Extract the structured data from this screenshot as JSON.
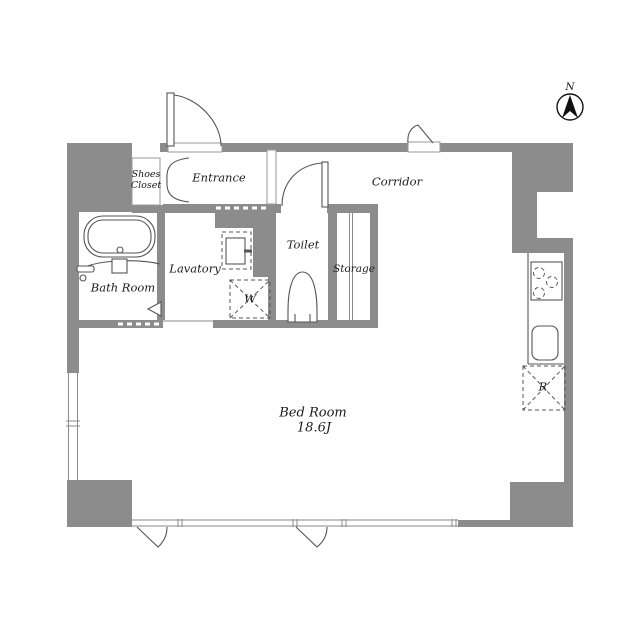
{
  "title": "Floor plan",
  "compass": {
    "north": "N"
  },
  "rooms": {
    "shoes_closet": {
      "line1": "Shoes",
      "line2": "Closet"
    },
    "entrance": {
      "label": "Entrance"
    },
    "corridor": {
      "label": "Corridor"
    },
    "toilet": {
      "label": "Toilet"
    },
    "storage": {
      "label": "Storage"
    },
    "lavatory": {
      "label": "Lavatory"
    },
    "bath_room": {
      "label": "Bath Room"
    },
    "bed_room": {
      "label": "Bed Room",
      "size": "18.6J"
    }
  },
  "appliances": {
    "washing_machine": "W",
    "refrigerator": "R"
  },
  "colors": {
    "wall": "#8c8c8c",
    "line": "#555555",
    "text": "#1b1b1b",
    "background": "#ffffff"
  }
}
